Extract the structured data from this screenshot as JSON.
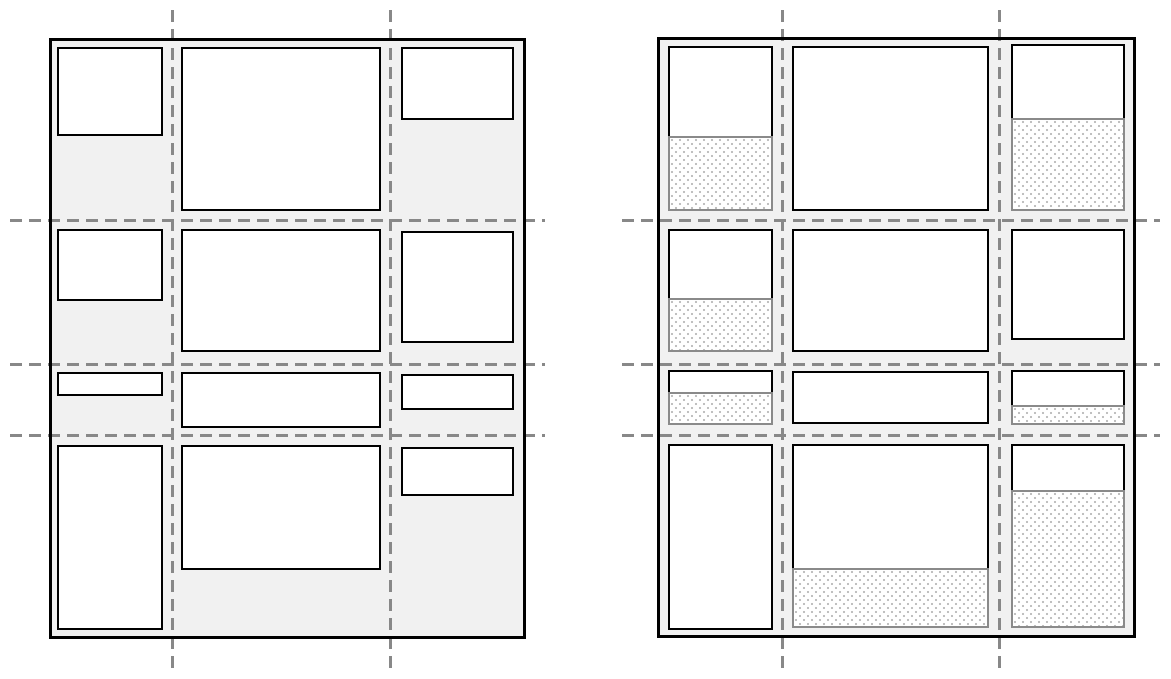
{
  "page": {
    "width": 1171,
    "height": 679
  },
  "colors": {
    "page_background": "#ffffff",
    "container_fill": "#f1f1f1",
    "container_border": "#000000",
    "item_fill": "#ffffff",
    "item_border": "#000000",
    "free_space_fill": "#ffffff",
    "free_space_border": "#8a8a8a",
    "free_space_dot": "#bdbdbd",
    "grid_line": "#888888"
  },
  "grid_line_style": {
    "thickness": 3,
    "dash": 12,
    "gap": 7
  },
  "figures": [
    {
      "name": "grid-figure-left-content-sized-items",
      "container": {
        "x": 49,
        "y": 38,
        "w": 477,
        "h": 601
      },
      "column_lines": [
        172,
        390
      ],
      "row_lines": [
        220,
        364,
        435
      ],
      "vertical_line_span": {
        "from_y": 10,
        "to_y": 670
      },
      "horizontal_line_span": {
        "from_x": 10,
        "to_x": 545
      },
      "cells": [
        {
          "row": 1,
          "col": 1,
          "x": 57,
          "y": 47,
          "w": 106,
          "item_h": 89,
          "free_h": 0
        },
        {
          "row": 1,
          "col": 2,
          "x": 181,
          "y": 47,
          "w": 200,
          "item_h": 164,
          "free_h": 0
        },
        {
          "row": 1,
          "col": 3,
          "x": 401,
          "y": 47,
          "w": 113,
          "item_h": 73,
          "free_h": 0
        },
        {
          "row": 2,
          "col": 1,
          "x": 57,
          "y": 229,
          "w": 106,
          "item_h": 72,
          "free_h": 0
        },
        {
          "row": 2,
          "col": 2,
          "x": 181,
          "y": 229,
          "w": 200,
          "item_h": 123,
          "free_h": 0
        },
        {
          "row": 2,
          "col": 3,
          "x": 401,
          "y": 231,
          "w": 113,
          "item_h": 112,
          "free_h": 0
        },
        {
          "row": 3,
          "col": 1,
          "x": 57,
          "y": 372,
          "w": 106,
          "item_h": 24,
          "free_h": 0
        },
        {
          "row": 3,
          "col": 2,
          "x": 181,
          "y": 372,
          "w": 200,
          "item_h": 56,
          "free_h": 0
        },
        {
          "row": 3,
          "col": 3,
          "x": 401,
          "y": 374,
          "w": 113,
          "item_h": 36,
          "free_h": 0
        },
        {
          "row": 4,
          "col": 1,
          "x": 57,
          "y": 445,
          "w": 106,
          "item_h": 185,
          "free_h": 0
        },
        {
          "row": 4,
          "col": 2,
          "x": 181,
          "y": 445,
          "w": 200,
          "item_h": 125,
          "free_h": 0
        },
        {
          "row": 4,
          "col": 3,
          "x": 401,
          "y": 447,
          "w": 113,
          "item_h": 49,
          "free_h": 0
        }
      ]
    },
    {
      "name": "grid-figure-right-items-with-free-space",
      "container": {
        "x": 657,
        "y": 37,
        "w": 479,
        "h": 601
      },
      "column_lines": [
        782,
        999
      ],
      "row_lines": [
        220,
        364,
        435
      ],
      "vertical_line_span": {
        "from_y": 10,
        "to_y": 670
      },
      "horizontal_line_span": {
        "from_x": 622,
        "to_x": 1160
      },
      "cells": [
        {
          "row": 1,
          "col": 1,
          "x": 668,
          "y": 46,
          "w": 105,
          "item_h": 90,
          "free_h": 75
        },
        {
          "row": 1,
          "col": 2,
          "x": 792,
          "y": 46,
          "w": 197,
          "item_h": 165,
          "free_h": 0
        },
        {
          "row": 1,
          "col": 3,
          "x": 1011,
          "y": 44,
          "w": 114,
          "item_h": 74,
          "free_h": 93
        },
        {
          "row": 2,
          "col": 1,
          "x": 668,
          "y": 229,
          "w": 105,
          "item_h": 69,
          "free_h": 54
        },
        {
          "row": 2,
          "col": 2,
          "x": 792,
          "y": 229,
          "w": 197,
          "item_h": 123,
          "free_h": 0
        },
        {
          "row": 2,
          "col": 3,
          "x": 1011,
          "y": 229,
          "w": 114,
          "item_h": 111,
          "free_h": 0
        },
        {
          "row": 3,
          "col": 1,
          "x": 668,
          "y": 370,
          "w": 105,
          "item_h": 22,
          "free_h": 33
        },
        {
          "row": 3,
          "col": 2,
          "x": 792,
          "y": 371,
          "w": 197,
          "item_h": 53,
          "free_h": 0
        },
        {
          "row": 3,
          "col": 3,
          "x": 1011,
          "y": 370,
          "w": 114,
          "item_h": 35,
          "free_h": 20
        },
        {
          "row": 4,
          "col": 1,
          "x": 668,
          "y": 444,
          "w": 105,
          "item_h": 186,
          "free_h": 0
        },
        {
          "row": 4,
          "col": 2,
          "x": 792,
          "y": 444,
          "w": 197,
          "item_h": 124,
          "free_h": 60
        },
        {
          "row": 4,
          "col": 3,
          "x": 1011,
          "y": 444,
          "w": 114,
          "item_h": 46,
          "free_h": 138
        }
      ]
    }
  ]
}
